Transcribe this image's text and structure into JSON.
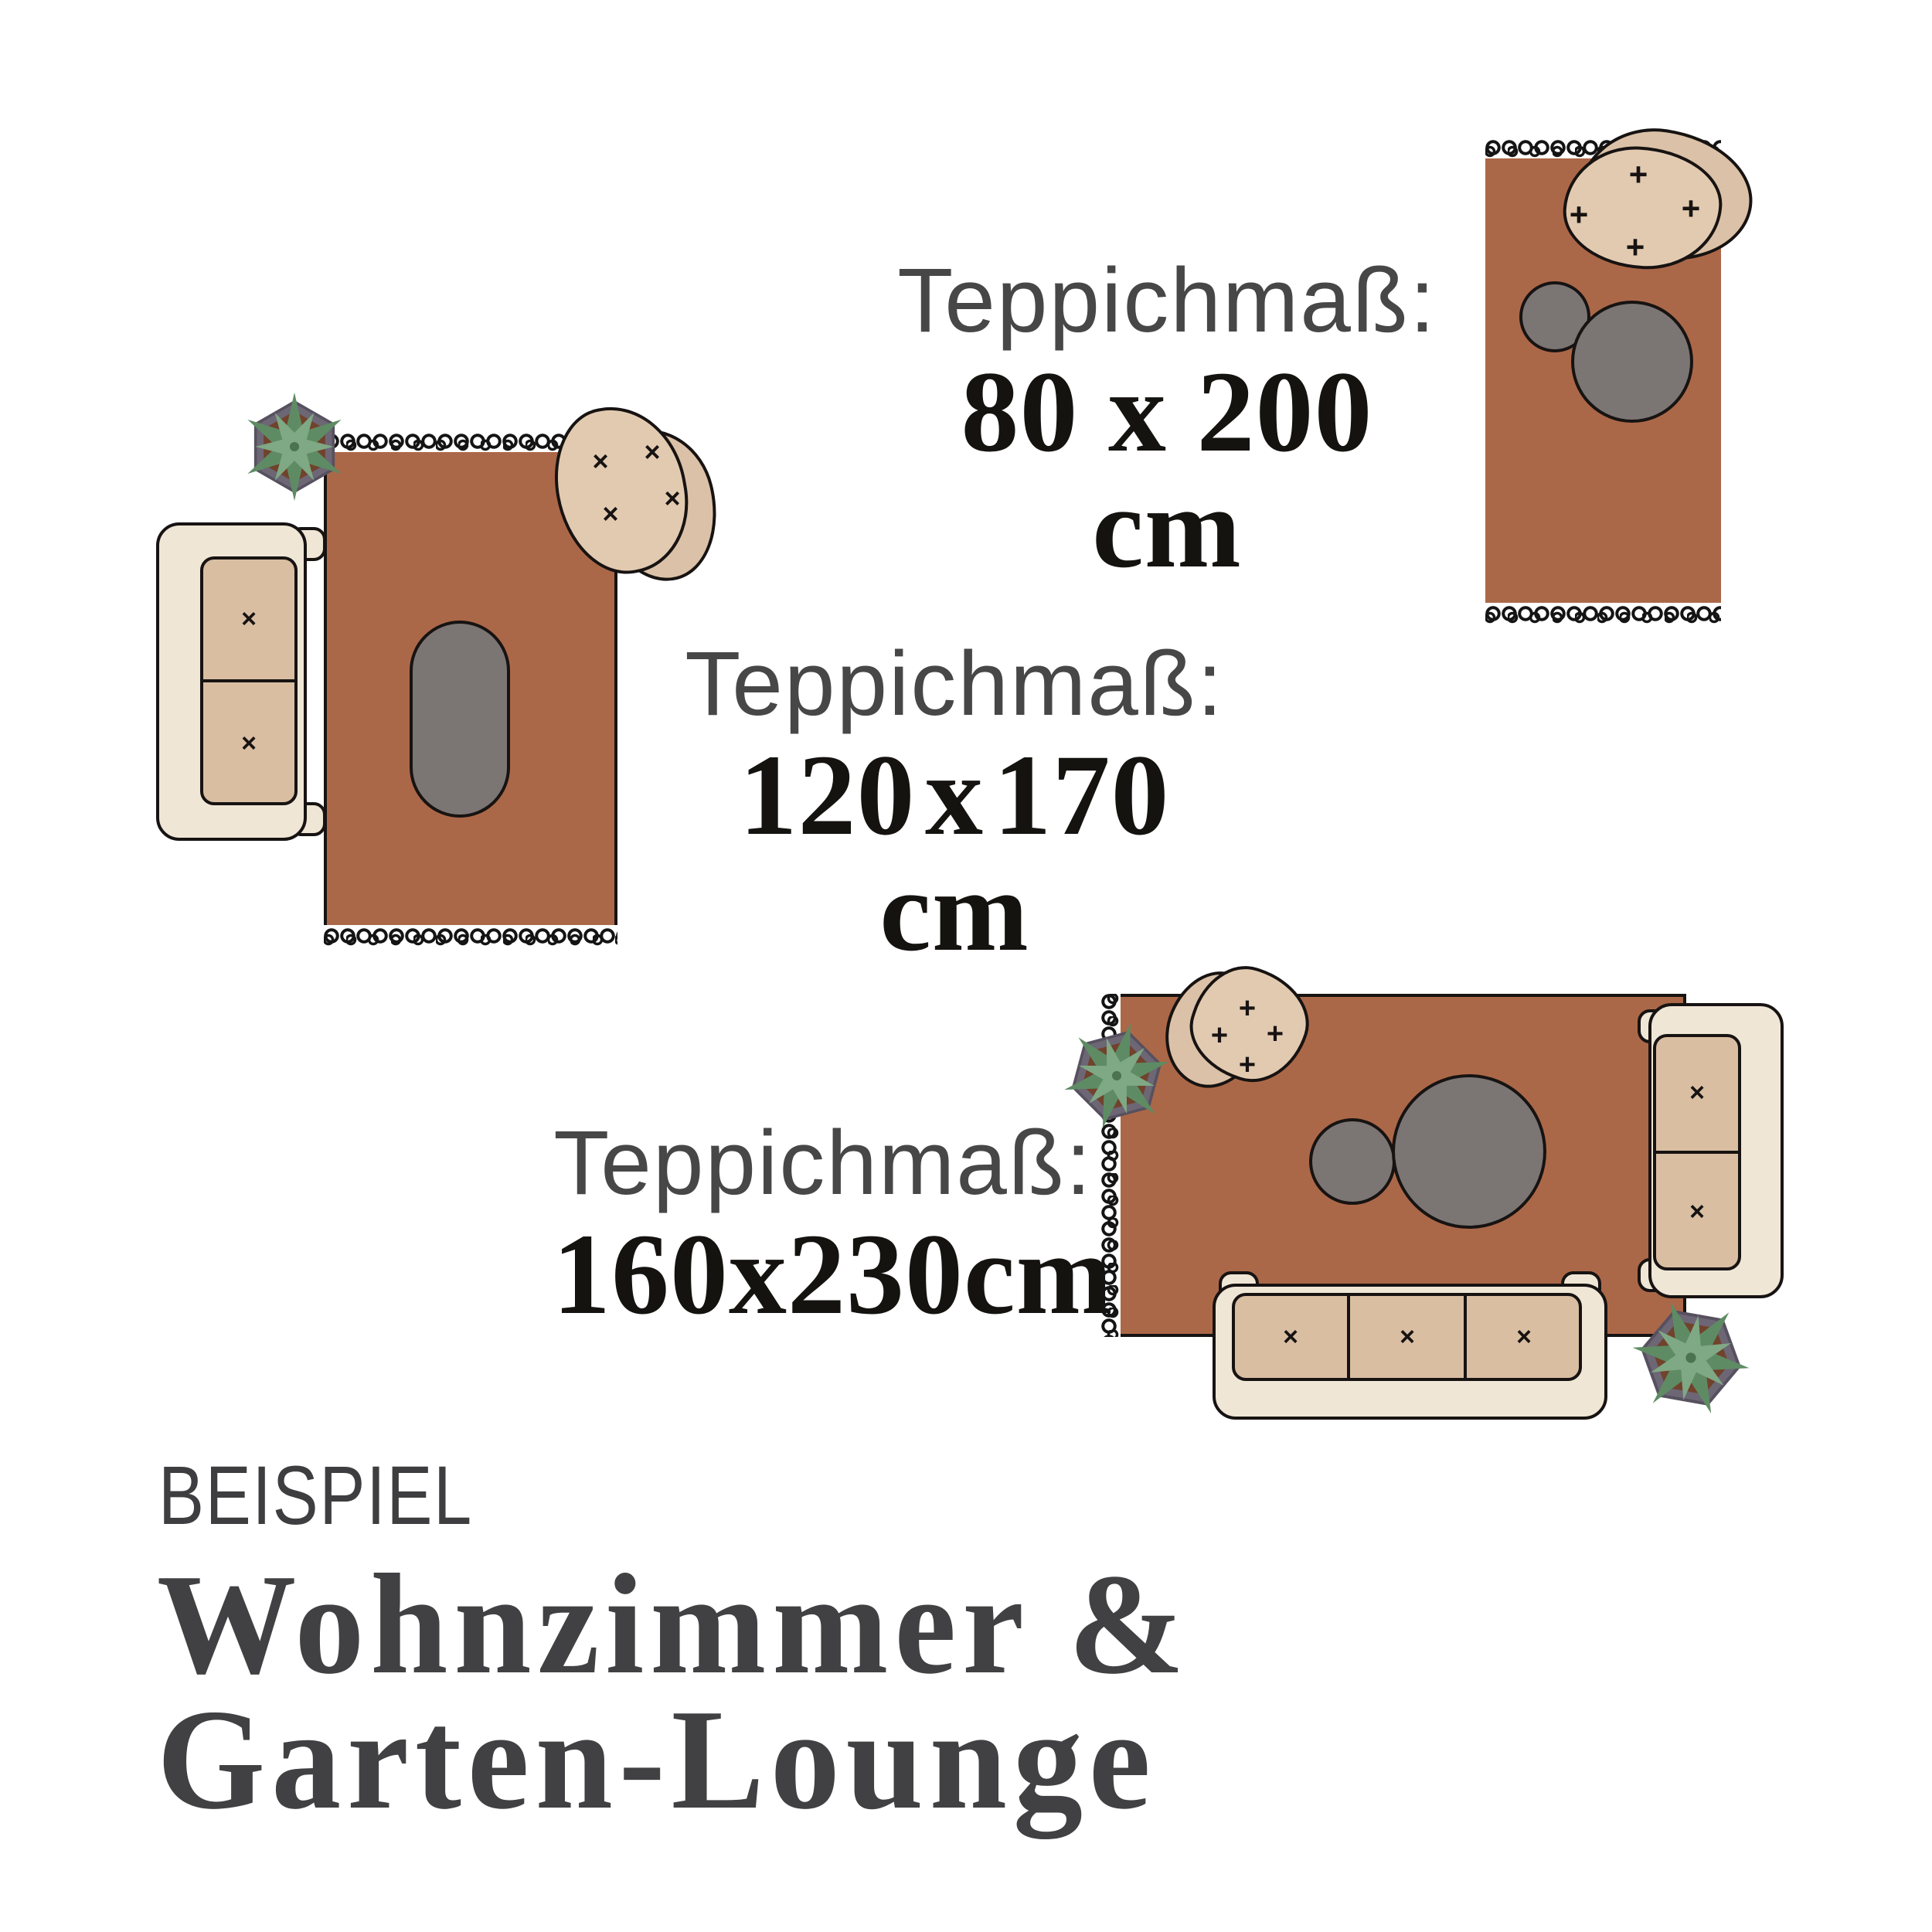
{
  "marks": {
    "plus": "+",
    "cross": "×"
  },
  "colors": {
    "rug": "#AB6848",
    "coffee_table_grey": "#7B7674",
    "outline": "#171312",
    "sofa_base": "#EFE6D6",
    "sofa_cushion": "#D9BEA2",
    "chair_back": "#DBC1A7",
    "chair_seat": "#E2CAB1",
    "leaf_dark": "#5E8B63",
    "leaf_light": "#7FA884",
    "pot_rim": "#6D6675",
    "pot_soil": "#71422C",
    "label_grey": "#474747",
    "value_black": "#151310",
    "heading_grey": "#414143"
  },
  "scenes": {
    "a": {
      "name": "rug 80x200 with armchair and side tables",
      "label": "Teppichmaß:",
      "size": "80 x 200 cm"
    },
    "b": {
      "name": "rug 120x170 with sofa, armchair and oval table",
      "label": "Teppichmaß:",
      "size": "120 x 170 cm"
    },
    "c": {
      "name": "rug 160x230 lounge with two sofas",
      "label": "Teppichmaß:",
      "size": "160x230cm"
    }
  },
  "footer": {
    "eyebrow": "BEISPIEL",
    "title_line1": "Wohnzimmer &",
    "title_line2": "Garten-Lounge"
  }
}
